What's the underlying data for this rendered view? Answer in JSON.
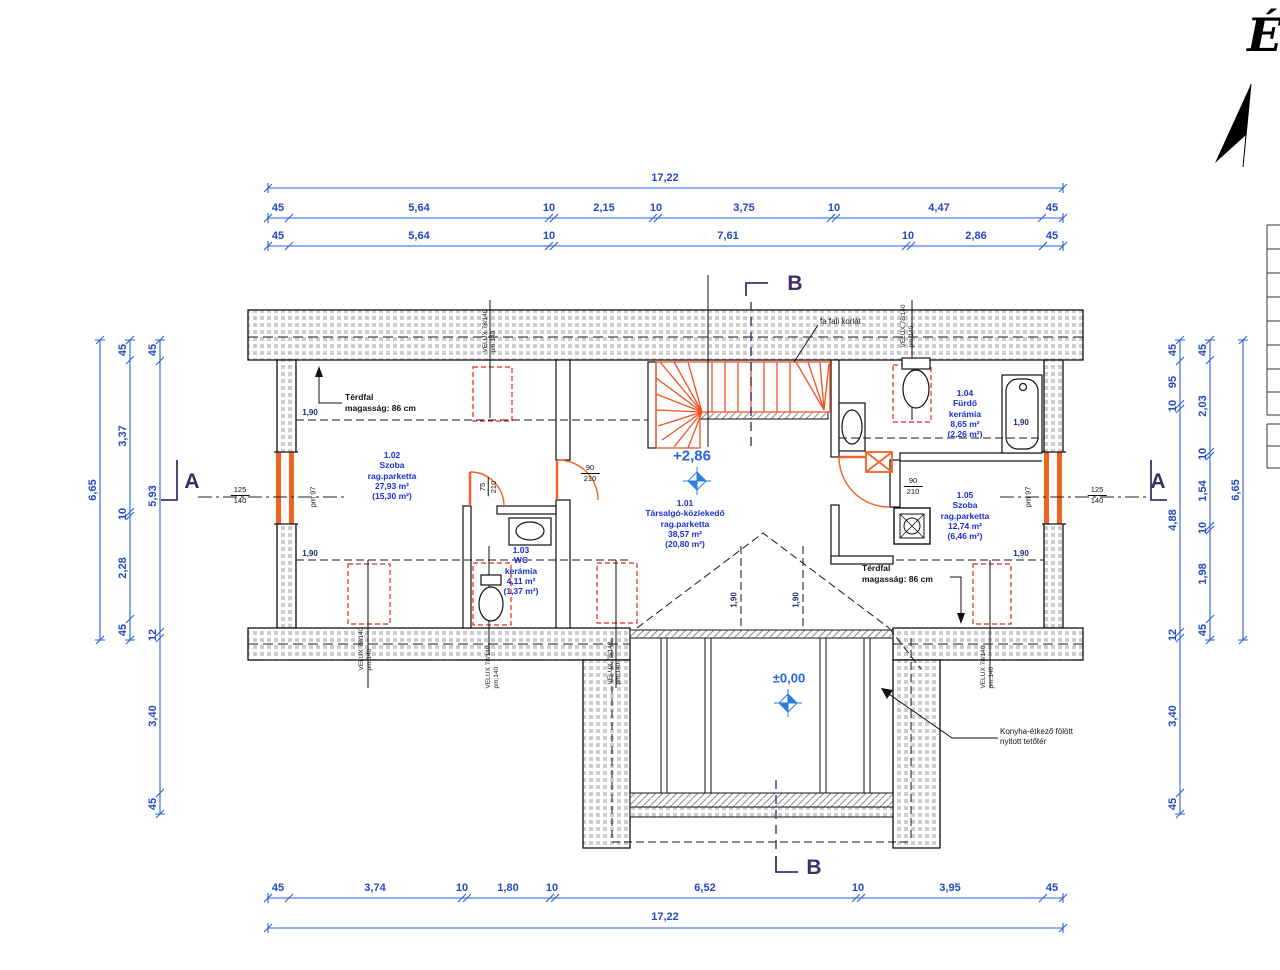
{
  "north_label": "É",
  "section_markers": {
    "a_left": "A",
    "a_right": "A",
    "b_top": "B",
    "b_bottom": "B"
  },
  "dimensions": {
    "top_total": "17,22",
    "top_row1": [
      "45",
      "5,64",
      "10",
      "2,15",
      "10",
      "3,75",
      "10",
      "4,47",
      "45"
    ],
    "top_row2": [
      "45",
      "5,64",
      "10",
      "7,61",
      "10",
      "2,86",
      "45"
    ],
    "bottom_row": [
      "45",
      "3,74",
      "10",
      "1,80",
      "10",
      "6,52",
      "10",
      "3,95",
      "45"
    ],
    "bottom_total": "17,22",
    "left_outer": "6,65",
    "left_mid": [
      "45",
      "3,37",
      "10",
      "2,28",
      "45"
    ],
    "left_inner": [
      "45",
      "5,93",
      "12",
      "3,40",
      "45"
    ],
    "right_inner": [
      "45",
      "95",
      "10",
      "4,88",
      "12",
      "3,40",
      "45"
    ],
    "right_mid": [
      "45",
      "2,03",
      "10",
      "1,54",
      "10",
      "1,98",
      "45"
    ],
    "right_outer": "6,65"
  },
  "rooms": [
    {
      "id": "1.02",
      "name": "Szoba",
      "finish": "rag.parketta",
      "area": "27,93 m²",
      "reduced_area": "(15,30 m²)"
    },
    {
      "id": "1.01",
      "name": "Társalgó-közlekedő",
      "finish": "rag.parketta",
      "area": "38,57 m²",
      "reduced_area": "(20,80 m²)"
    },
    {
      "id": "1.03",
      "name": "WC",
      "finish": "kerámia",
      "area": "4,11 m²",
      "reduced_area": "(1,37 m²)"
    },
    {
      "id": "1.04",
      "name": "Fürdő",
      "finish": "kerámia",
      "area": "8,65 m²",
      "reduced_area": "(2,26 m²)"
    },
    {
      "id": "1.05",
      "name": "Szoba",
      "finish": "rag.parketta",
      "area": "12,74 m²",
      "reduced_area": "(6,46 m²)"
    }
  ],
  "levels": {
    "upper": "+2,86",
    "ground": "±0,00"
  },
  "annotations": {
    "kneewall_left_line1": "Térdfal",
    "kneewall_left_line2": "magasság: 86 cm",
    "kneewall_right_line1": "Térdfal",
    "kneewall_right_line2": "magasság: 86 cm",
    "stair_railing": "fa fali korlát",
    "void_line1": "Konyha-étkező fölött",
    "void_line2": "nyitott tetőtér"
  },
  "velux_label": {
    "line1": "VELUX 78/140",
    "line2": "pm:140"
  },
  "openings": {
    "window_width": "125",
    "window_height": "140",
    "window_parapet": "pm 97",
    "door_width": "90",
    "door_height": "210",
    "wc_door_width": "75",
    "wc_door_height": "210"
  },
  "headroom": "1,90",
  "bathtub_length": "1,90"
}
